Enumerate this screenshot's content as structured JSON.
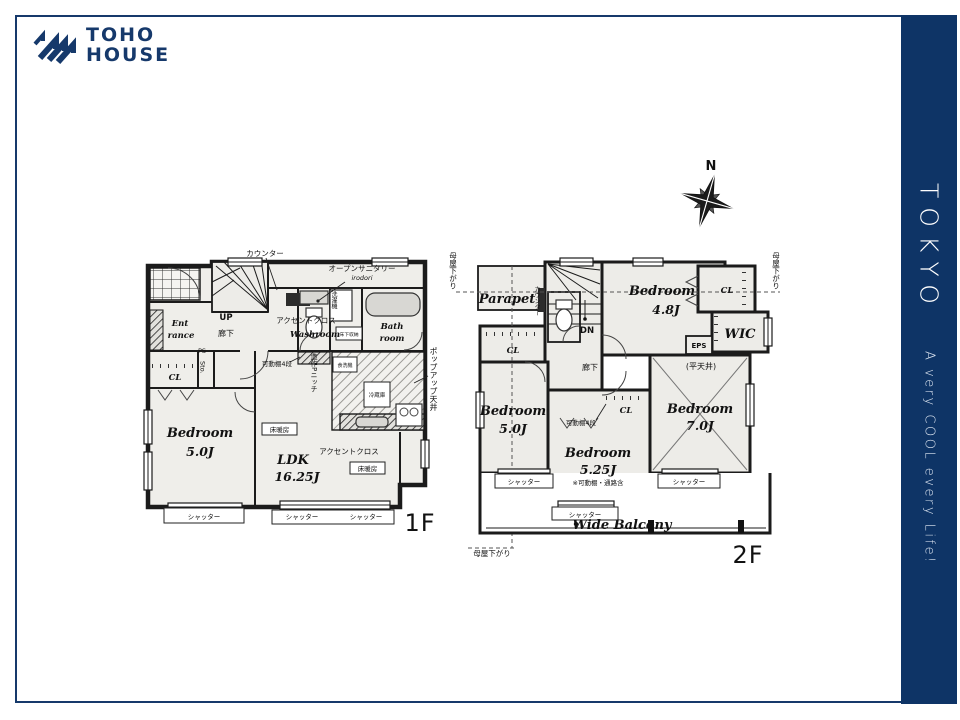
{
  "logo": {
    "line1": "TOHO",
    "line2": "HOUSE"
  },
  "sidebar": {
    "title": "TOKYO",
    "tagline": "A very COOL every Life!"
  },
  "colors": {
    "brand_navy": "#0e3466"
  },
  "compass": {
    "north": "N"
  },
  "f1": {
    "tag": "1F",
    "counter": "カウンター",
    "open_san1": "オープンサニタリー",
    "open_san2": "irodori",
    "up": "UP",
    "ent1": "Ent",
    "ent2": "rance",
    "hallway": "廊下",
    "ps": "PS",
    "cl": "CL",
    "sto": "Sto.",
    "laundry": "洗濯機",
    "underfloor": "床下収納",
    "accent1": "アクセントクロス",
    "washroom": "Washroom",
    "bath1": "Bath",
    "bath2": "room",
    "shelf": "可動棚4段",
    "niche": "造作Pニッチ",
    "dishwasher": "食洗機",
    "fridge": "冷蔵庫",
    "popup": "ポップアップ天井",
    "heat1": "床暖房",
    "heat2": "床暖房",
    "bed_name": "Bedroom",
    "bed_size": "5.0J",
    "ldk_name": "LDK",
    "ldk_size": "16.25J",
    "accent2": "アクセントクロス",
    "shutter1": "シャッター",
    "shutter2": "シャッター",
    "shutter3": "シャッター"
  },
  "f2": {
    "tag": "2F",
    "moya_left": "母屋下がり",
    "moya_right": "母屋下がり",
    "moya_bottom": "母屋下がり",
    "parapet": "Parapet",
    "counter": "カウンター",
    "dn": "DN",
    "hallway": "廊下",
    "cl_left": "CL",
    "cl_top": "CL",
    "cl_mid": "CL",
    "wic": "WIC",
    "eps": "EPS",
    "flat_ceiling": "(平天井)",
    "shelf": "可動棚4段",
    "bed48_name": "Bedroom",
    "bed48_size": "4.8J",
    "bed50_name": "Bedroom",
    "bed50_size": "5.0J",
    "bed525_name": "Bedroom",
    "bed525_size": "5.25J",
    "bed525_note": "※可動棚・通路含",
    "bed70_name": "Bedroom",
    "bed70_size": "7.0J",
    "balcony": "Wide Balcony",
    "shutter1": "シャッター",
    "shutter2": "シャッター",
    "shutter3": "シャッター"
  }
}
